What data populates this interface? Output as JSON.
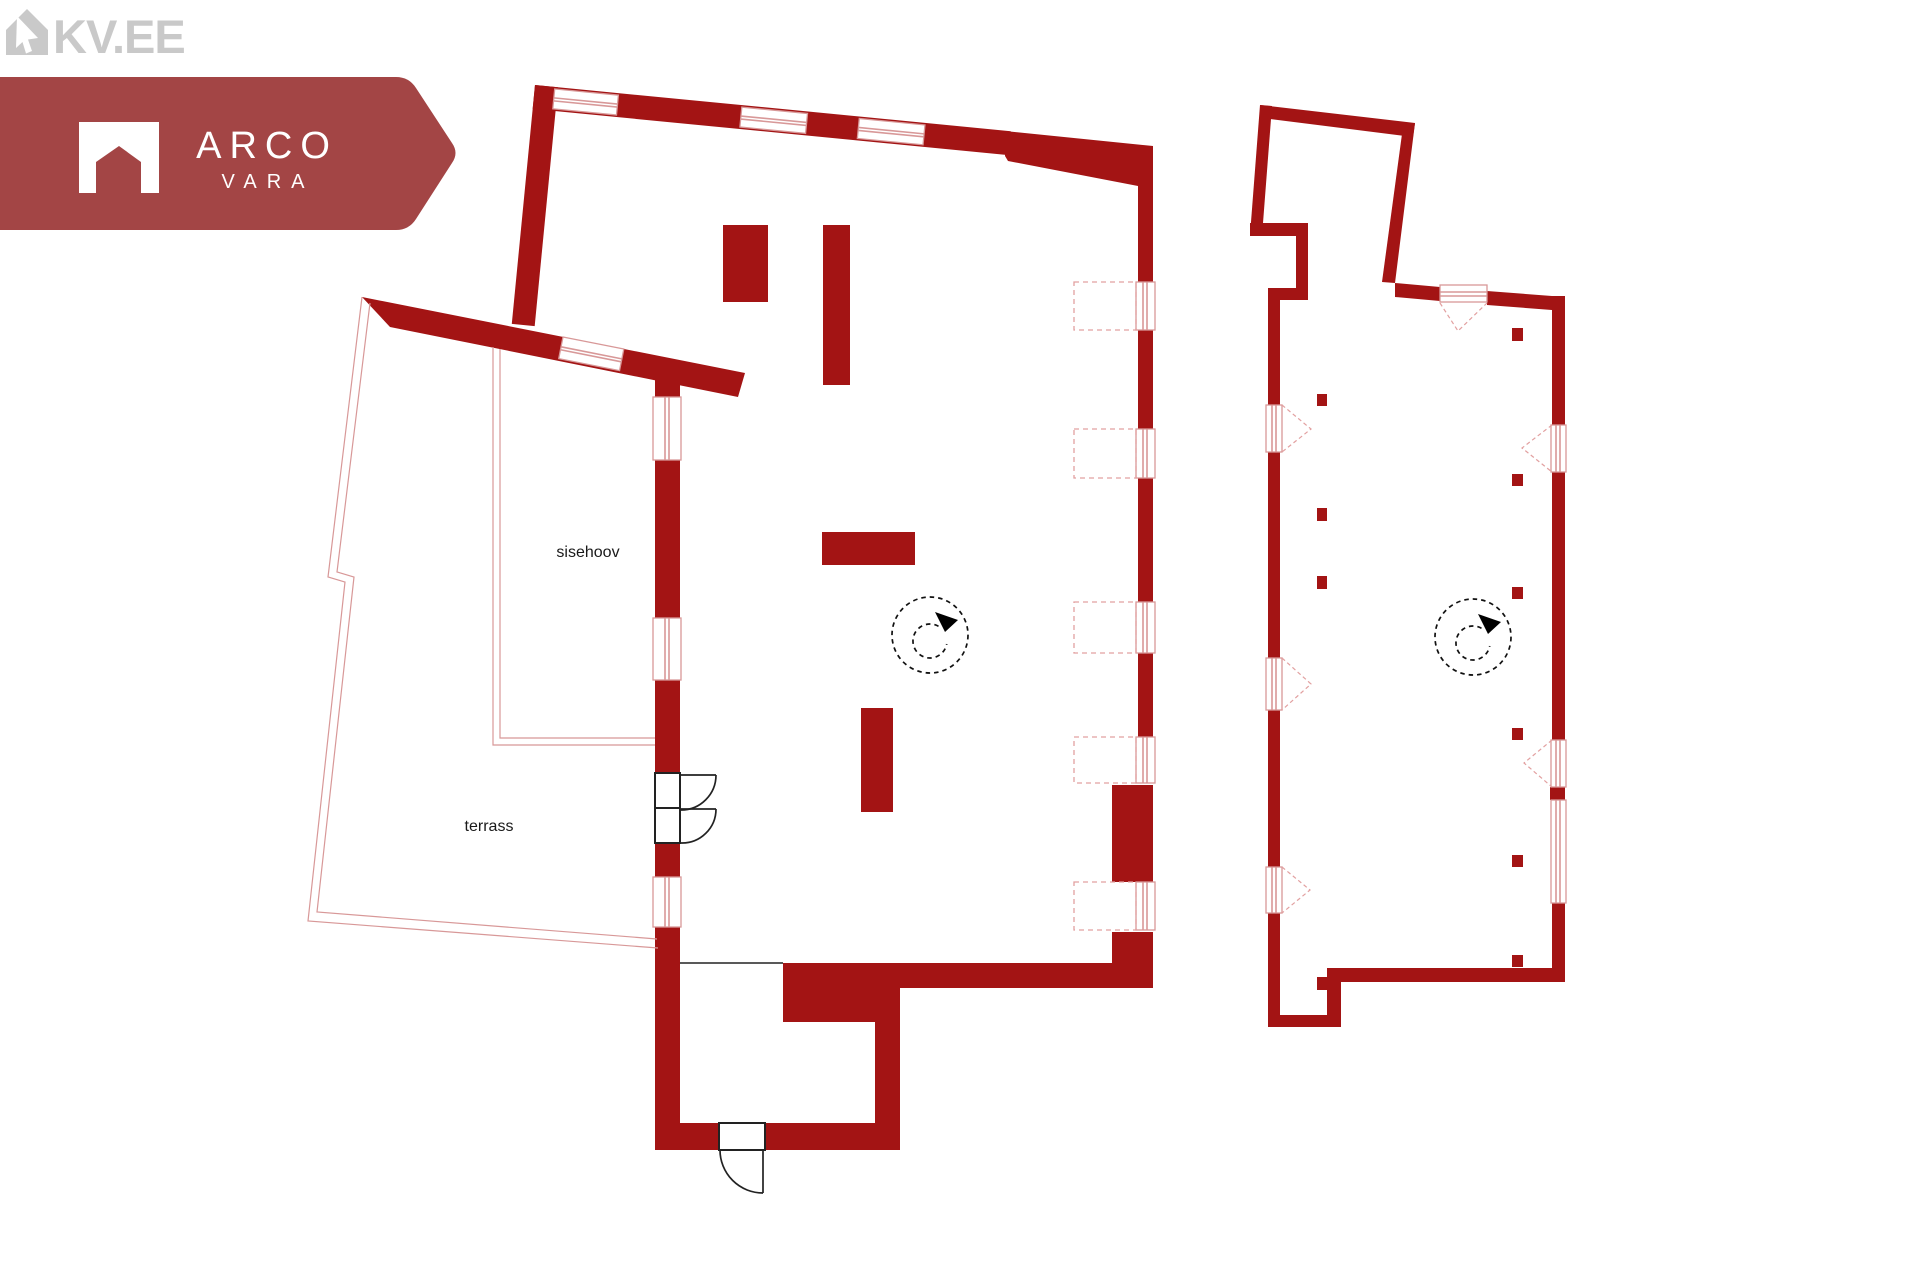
{
  "branding": {
    "kv_logo": "KV.EE",
    "agency_name": "ARCO",
    "agency_sub": "VARA"
  },
  "floorplan": {
    "courtyard_label": "sisehoov",
    "terrace_label": "terrass"
  },
  "icons": [
    "kv-house-cursor-icon",
    "arco-house-icon",
    "north-rotation-compass-icon",
    "double-door-icon",
    "single-door-icon"
  ],
  "colors": {
    "wall": "#a31414",
    "banner": "#a34545",
    "kvgray": "#c9c9c9",
    "thin": "#d89898",
    "dash": "#e2a0a0",
    "ink": "#1a1a1a",
    "bg": "#ffffff"
  }
}
